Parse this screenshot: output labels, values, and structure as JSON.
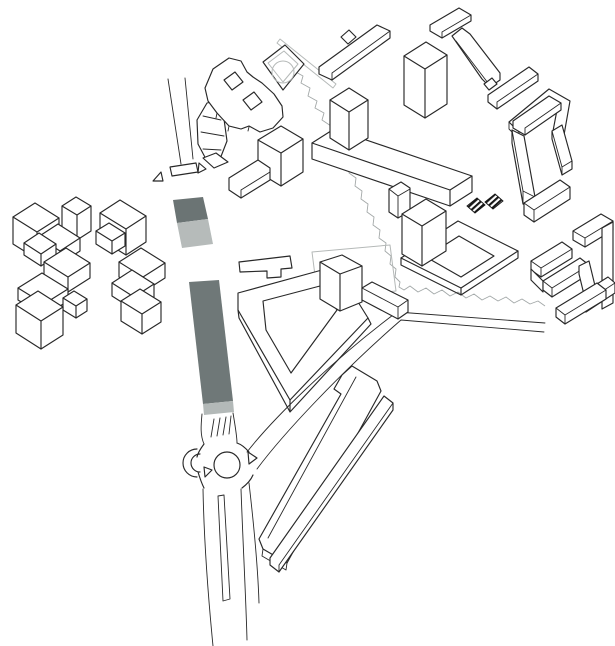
{
  "figure": {
    "type": "axonometric-site-massing-diagram",
    "background": "#ffffff",
    "colors": {
      "outline": "#282828",
      "light_outline": "#b5b9b8",
      "path_gray": "#a3a8a8",
      "site_parcel_dark": "#6b7474",
      "site_parcel_light": "#b6bbba",
      "boulevard": "#6f7878",
      "boulevard_end": "#b3b9b8",
      "building_fill": "#ffffff",
      "hatch_stripe": "#161616"
    },
    "elements": {
      "site_parcel": "two-tone highlighted site parcel",
      "boulevard": "highlighted boulevard axis",
      "roundabout": "roundabout with center island",
      "figure_eight_building": "figure-eight perimeter building",
      "circle_court_building": "tilted court building with circular element",
      "hatched_structures": "pair of hatched structures",
      "west_clusters": "western housing block clusters",
      "center_complex": "central slab-and-tower complex",
      "east_courtyard_blocks": "eastern courtyard perimeter blocks",
      "v_block": "v-shaped perimeter block with tower",
      "south_slabs": "diagonal linear slabs",
      "tree_line": "meandering landscape line"
    }
  }
}
